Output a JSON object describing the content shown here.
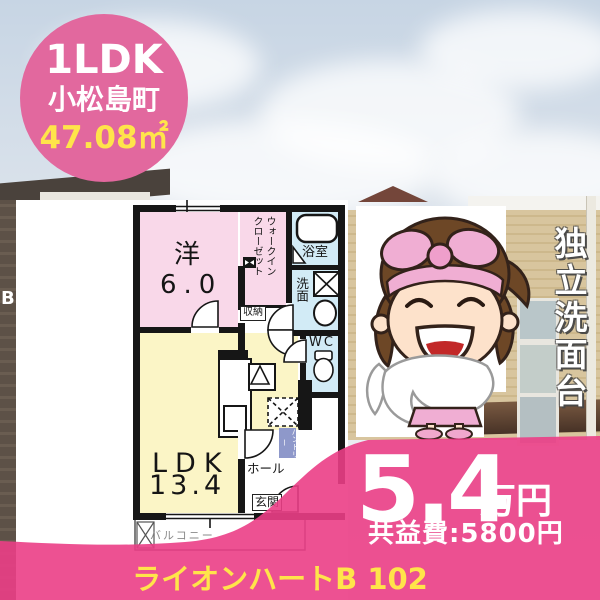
{
  "badge": {
    "line1": "1LDK",
    "line2": "小松島町",
    "line3": "47.08㎡"
  },
  "floorplan": {
    "labels": {
      "room1": "洋",
      "room1_size": "6.0",
      "wic_line1": "ウォークイン",
      "wic_line2": "クローゼット",
      "bath": "浴室",
      "wash": "洗面",
      "wc": "WC",
      "storage": "収納",
      "ldk": "LDK",
      "ldk_size": "13.4",
      "hall": "ホール",
      "entrance": "玄関",
      "pantry": "パントリー",
      "balcony": "バルコニー"
    }
  },
  "feature": "独立洗面台",
  "price": {
    "amount": "5.4",
    "unit": "万円",
    "fee": "共益費:5800円"
  },
  "footer": {
    "building": "ライオンハートB 102"
  },
  "photo": {
    "sign_letter": "B"
  },
  "colors": {
    "accent_pink": "#eb3e86",
    "badge_pink": "#e2689e",
    "highlight_yellow": "#ffe44a",
    "plan_pink": "#f9d8e9",
    "plan_yellow": "#fbf5c6",
    "plan_blue": "#d2ebf6",
    "pantry_blue": "#8e98ca"
  }
}
